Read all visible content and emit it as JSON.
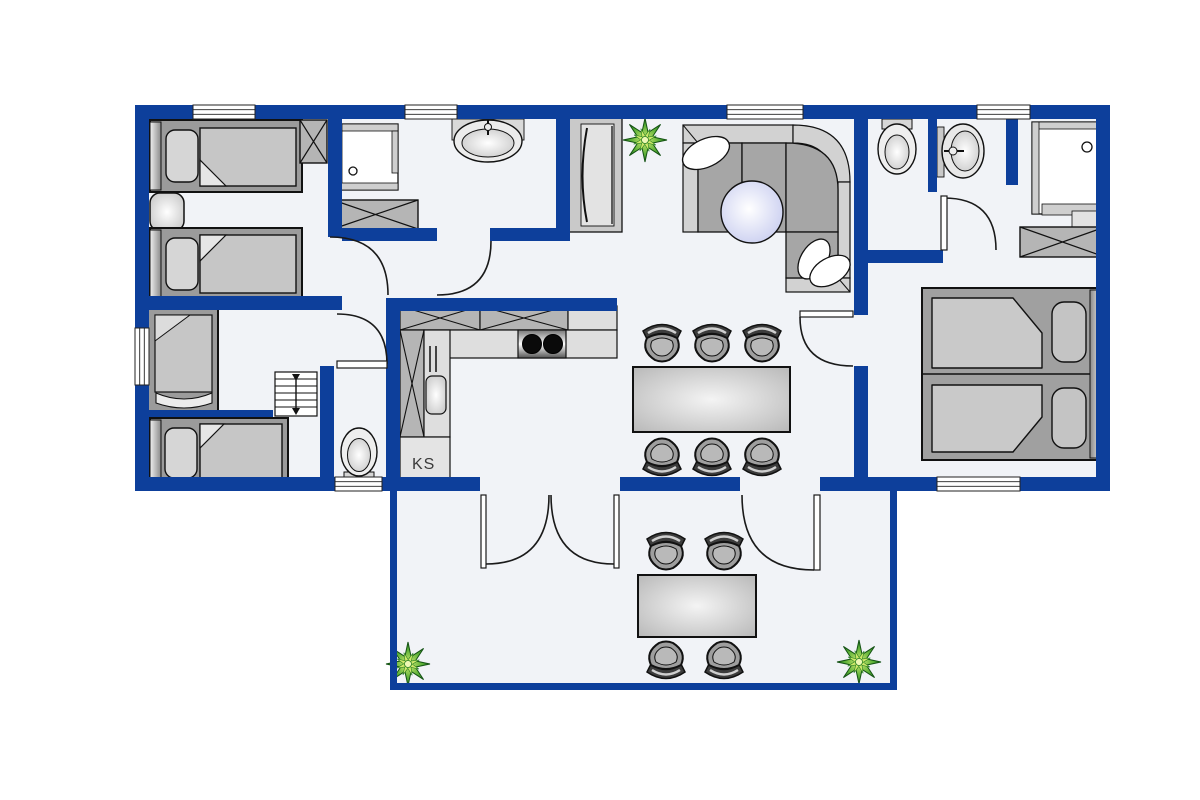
{
  "plan": {
    "type": "vacation-house-floor-plan",
    "labels": {
      "fridge": "KS"
    },
    "colors": {
      "wall": "#0d3f9b",
      "floor": "#f1f3f7",
      "furniture_dark": "#9b9b9b",
      "furniture_mid": "#b5b5b5",
      "furniture_light": "#dedede",
      "blanket": "#c6c6c6",
      "pillow": "#ffffff",
      "round_table": "#ccd1f2",
      "plant_green": "#2e8b2e",
      "outline": "#111111"
    },
    "rooms": [
      {
        "id": "bedroom-top-left",
        "items": [
          "single-bed",
          "single-bed",
          "nightstand",
          "wardrobe"
        ]
      },
      {
        "id": "bathroom-left",
        "items": [
          "shower",
          "washbasin",
          "wardrobe",
          "window"
        ]
      },
      {
        "id": "bedroom-middle-left",
        "items": [
          "single-bed",
          "window"
        ]
      },
      {
        "id": "bedroom-bottom-left",
        "items": [
          "single-bed"
        ]
      },
      {
        "id": "hallway",
        "items": [
          "stairs",
          "doors"
        ]
      },
      {
        "id": "wc-middle",
        "items": [
          "toilet",
          "window"
        ]
      },
      {
        "id": "kitchen",
        "items": [
          "upper-cabinets",
          "counter",
          "stove",
          "sink",
          "fridge"
        ]
      },
      {
        "id": "living-dining",
        "items": [
          "corner-sofa",
          "cushions",
          "round-table",
          "sideboard",
          "plant",
          "dining-table",
          "six-chairs"
        ]
      },
      {
        "id": "wc-top-right",
        "items": [
          "toilet"
        ]
      },
      {
        "id": "washroom-top-right",
        "items": [
          "washbasin"
        ]
      },
      {
        "id": "shower-room-right",
        "items": [
          "shower",
          "wardrobe"
        ]
      },
      {
        "id": "bedroom-right",
        "items": [
          "double-bed",
          "two-pillows",
          "window"
        ]
      },
      {
        "id": "terrace",
        "items": [
          "garden-table",
          "four-chairs",
          "plant",
          "plant",
          "french-doors"
        ]
      }
    ]
  }
}
